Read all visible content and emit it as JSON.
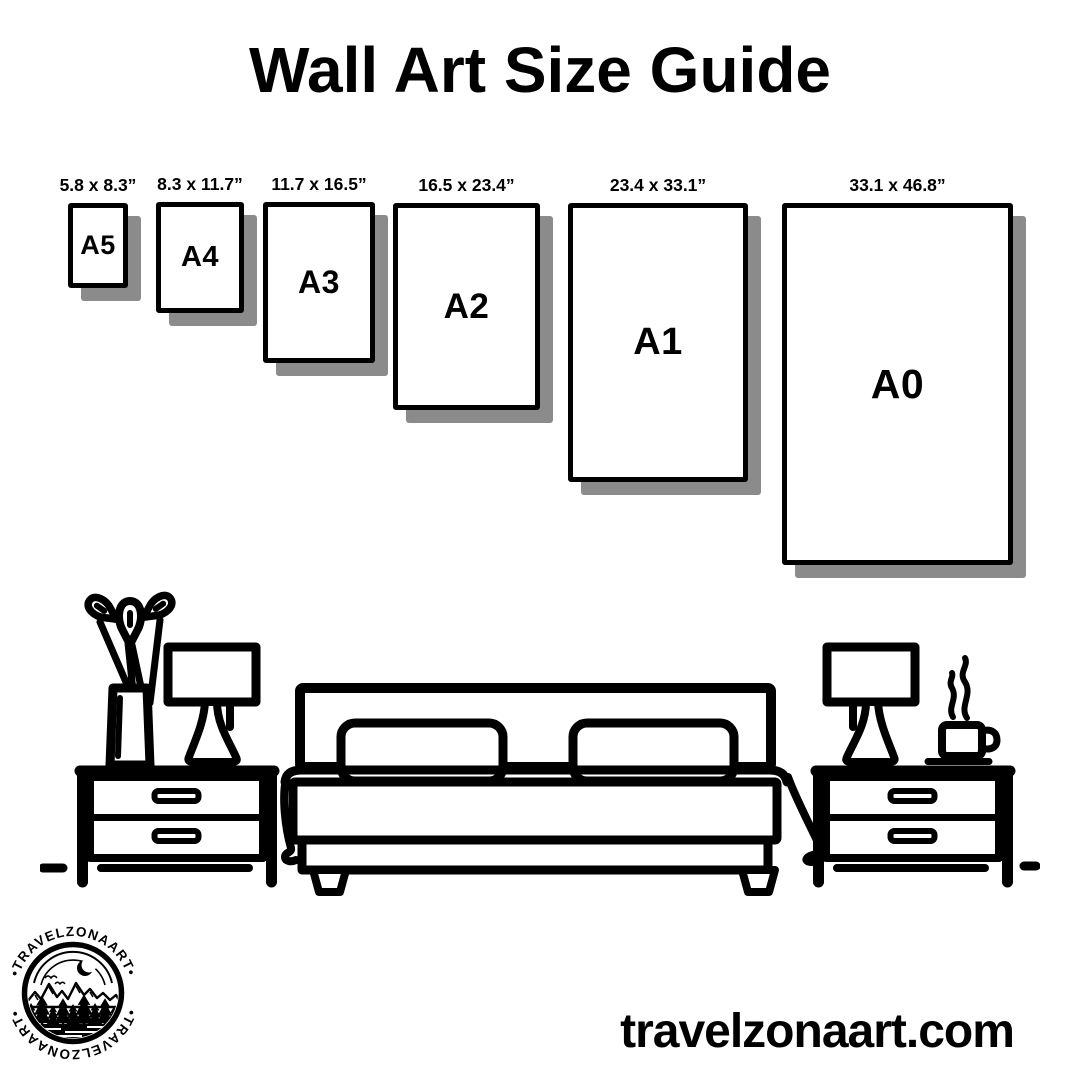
{
  "title": "Wall Art Size Guide",
  "colors": {
    "ink": "#000000",
    "shadow": "#8b8b8b",
    "background": "#ffffff"
  },
  "size_guide": {
    "sizes": [
      {
        "code": "A5",
        "dimensions": "5.8 x 8.3”",
        "x": 68,
        "y": 203,
        "w": 60,
        "h": 85,
        "font": 27
      },
      {
        "code": "A4",
        "dimensions": "8.3 x 11.7”",
        "x": 156,
        "y": 202,
        "w": 88,
        "h": 111,
        "font": 29
      },
      {
        "code": "A3",
        "dimensions": "11.7 x 16.5”",
        "x": 263,
        "y": 202,
        "w": 112,
        "h": 161,
        "font": 32
      },
      {
        "code": "A2",
        "dimensions": "16.5 x 23.4”",
        "x": 393,
        "y": 203,
        "w": 147,
        "h": 207,
        "font": 35
      },
      {
        "code": "A1",
        "dimensions": "23.4 x 33.1”",
        "x": 568,
        "y": 203,
        "w": 180,
        "h": 279,
        "font": 38
      },
      {
        "code": "A0",
        "dimensions": "33.1 x 46.8”",
        "x": 782,
        "y": 203,
        "w": 231,
        "h": 362,
        "font": 41
      }
    ]
  },
  "scene": {
    "items": [
      "flower-vase",
      "table-lamp",
      "nightstand",
      "double-bed",
      "coffee-cup"
    ]
  },
  "logo": {
    "arc_text_top": "•TRAVELZONAART•",
    "arc_text_bottom": "•TRAVELZONAART•"
  },
  "footer": {
    "website": "travelzonaart.com"
  }
}
